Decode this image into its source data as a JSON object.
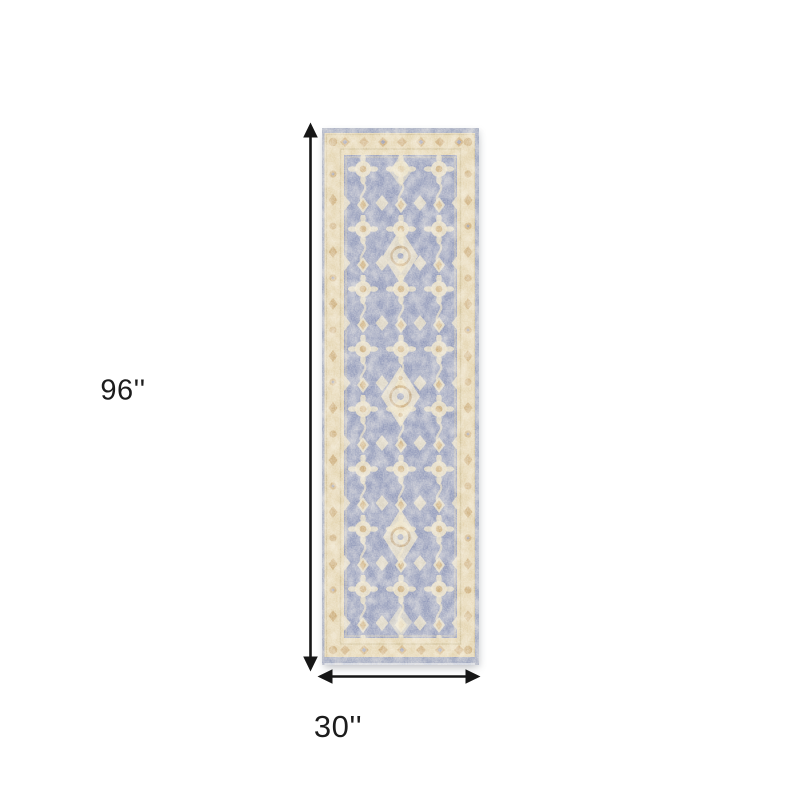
{
  "page": {
    "background_color": "#ffffff"
  },
  "diagram": {
    "height_dimension_label": "96''",
    "width_dimension_label": "30''",
    "arrow_color": "#161616",
    "label_color": "#1c1c1c"
  },
  "rug": {
    "colors": {
      "border-beige": "#e2d2ad",
      "field-blue": "#8d96b8",
      "motif-tan": "#c7a46e",
      "selvedge-blue": "#97a0bb",
      "cream": "#eadfc1"
    }
  }
}
